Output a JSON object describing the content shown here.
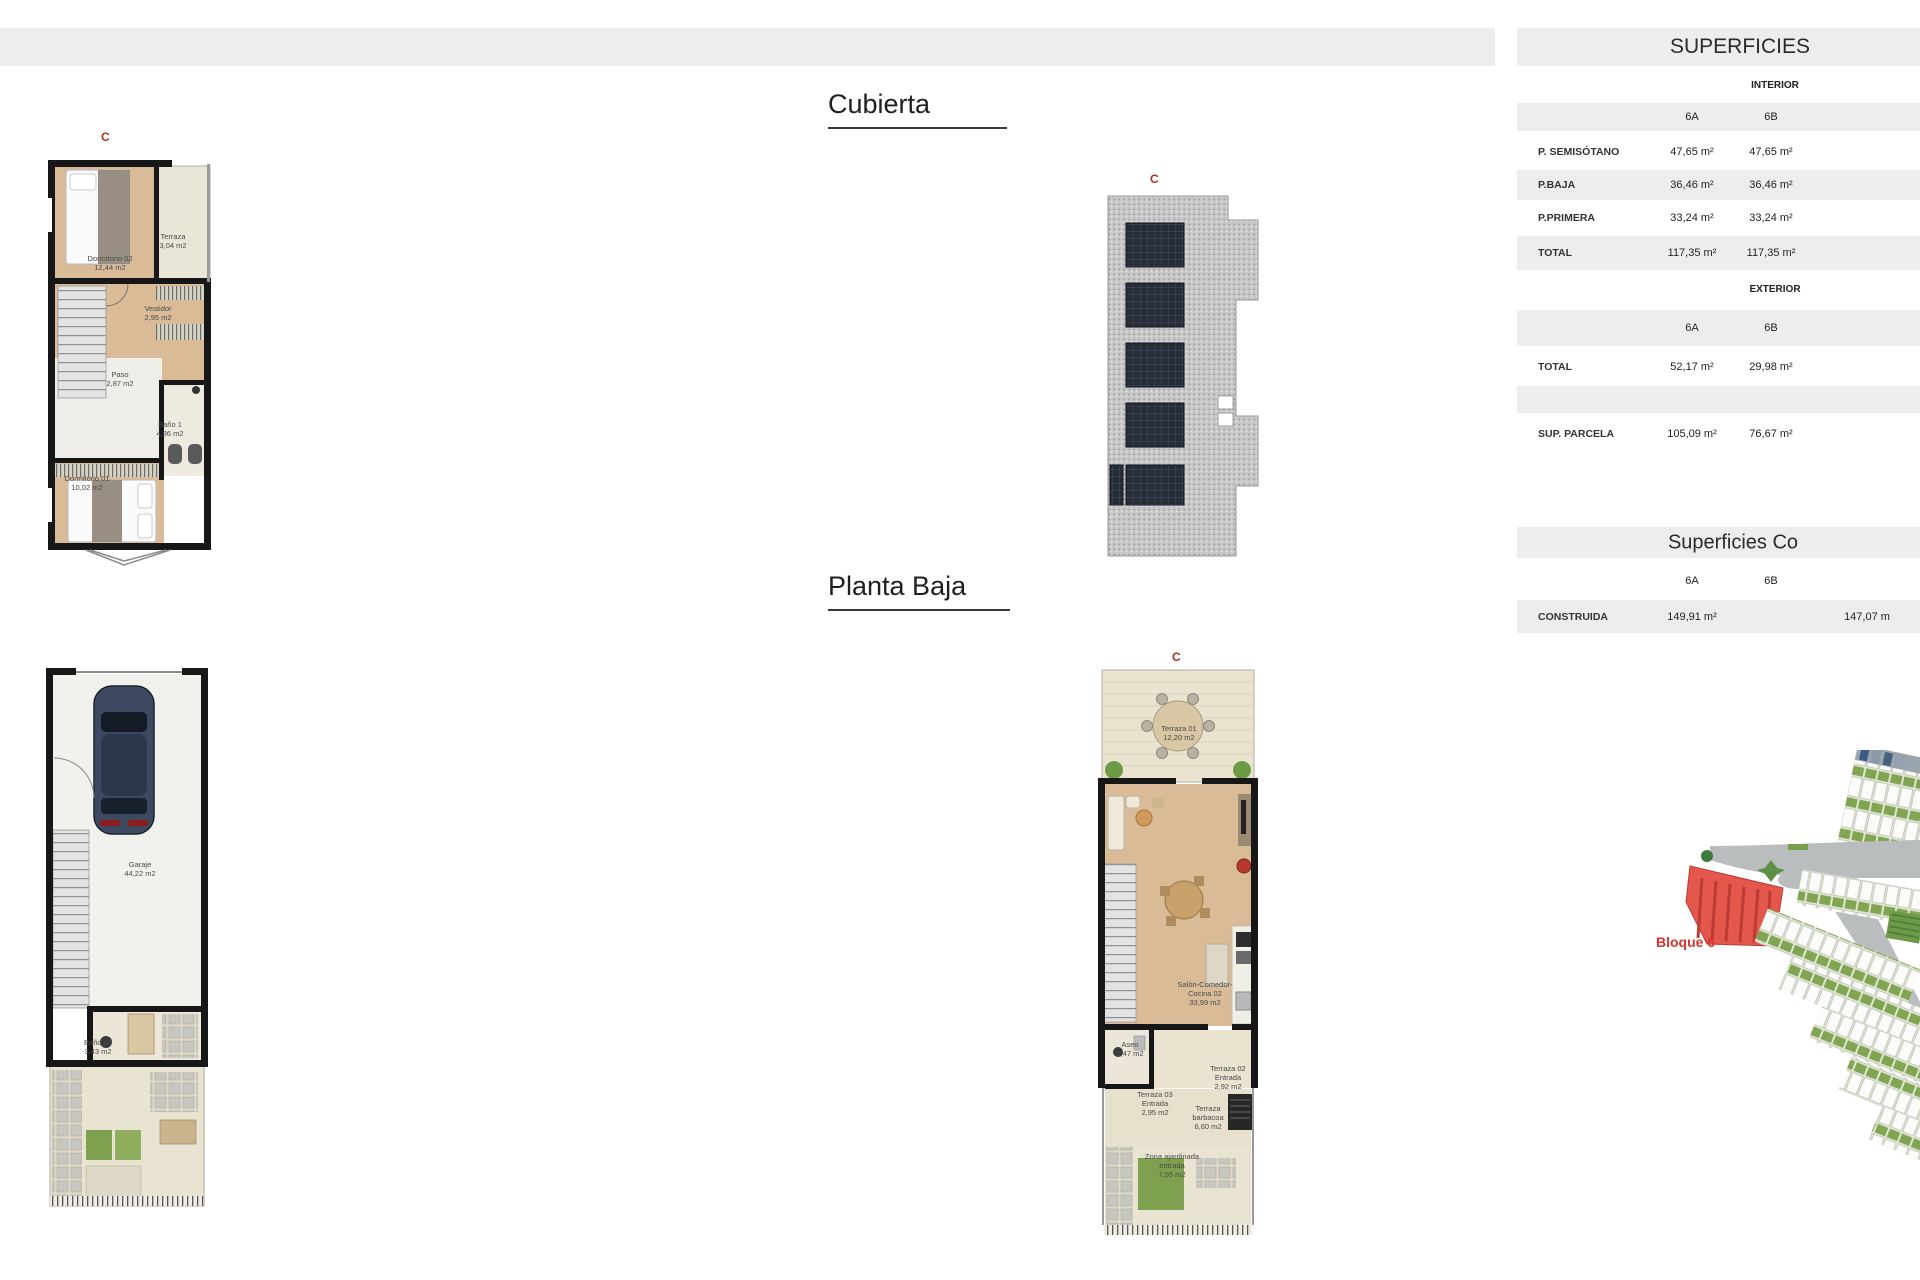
{
  "titles": {
    "cubierta": "Cubierta",
    "planta_baja": "Planta Baja"
  },
  "markers": {
    "c1": "C",
    "c2": "C",
    "c3": "C"
  },
  "plans": {
    "planta_primera": {
      "rooms": {
        "dormitorio02": {
          "name": "Dormitorio 02",
          "area": "12,44 m2"
        },
        "terraza": {
          "name": "Terraza",
          "area": "3,04 m2"
        },
        "vestidor": {
          "name": "Vestidor",
          "area": "2,95 m2"
        },
        "paso": {
          "name": "Paso",
          "area": "2,87 m2"
        },
        "bano1": {
          "name": "Baño 1",
          "area": "4,86 m2"
        },
        "dormitorio01": {
          "name": "Dormitorio 01",
          "area": "10,02 m2"
        }
      }
    },
    "semisotano": {
      "rooms": {
        "garaje": {
          "name": "Garaje",
          "area": "44,22 m2"
        },
        "bano01": {
          "name": "Baño 01",
          "area": "3,43 m2"
        }
      }
    },
    "planta_baja": {
      "rooms": {
        "terraza01": {
          "name": "Terraza 01",
          "area": "12,20 m2"
        },
        "salon": {
          "name": "Salón-Comedor-Cocina 02",
          "area": "33,99 m2"
        },
        "aseo": {
          "name": "Aseo",
          "area": "2,47 m2"
        },
        "terraza02": {
          "name": "Terraza 02 Entrada",
          "area": "2,92 m2"
        },
        "terraza03": {
          "name": "Terraza 03 Entrada",
          "area": "2,95 m2"
        },
        "barbacoa": {
          "name": "Terraza barbacoa",
          "area": "6,60 m2"
        },
        "zona": {
          "name": "Zona ajardinada entrada",
          "area": "7,55 m2"
        }
      }
    }
  },
  "superficies": {
    "title": "SUPERFICIES",
    "interior": {
      "header": "INTERIOR",
      "col_a": "6A",
      "col_b": "6B",
      "rows": [
        {
          "label": "P. SEMISÓTANO",
          "a": "47,65 m²",
          "b": "47,65 m²"
        },
        {
          "label": "P.BAJA",
          "a": "36,46 m²",
          "b": "36,46 m²"
        },
        {
          "label": "P.PRIMERA",
          "a": "33,24 m²",
          "b": "33,24 m²"
        },
        {
          "label": "TOTAL",
          "a": "117,35 m²",
          "b": "117,35 m²"
        }
      ]
    },
    "exterior": {
      "header": "EXTERIOR",
      "col_a": "6A",
      "col_b": "6B",
      "rows": [
        {
          "label": "TOTAL",
          "a": "52,17 m²",
          "b": "29,98 m²"
        },
        {
          "label": "SUP. PARCELA",
          "a": "105,09 m²",
          "b": "76,67 m²"
        }
      ]
    }
  },
  "construidas": {
    "title": "Superficies Co",
    "col_a": "6A",
    "col_b": "6B",
    "rows": [
      {
        "label": "CONSTRUIDA",
        "a": "149,91 m²",
        "b": "147,07 m"
      }
    ]
  },
  "site_plan": {
    "label": "Bloque 6"
  },
  "colors": {
    "accent_red": "#b03025",
    "bloque_red": "#d7352e",
    "row_shade": "#eceeee",
    "wood": "#d9bb97",
    "wall": "#171717",
    "road": "#b9bdbd",
    "green": "#7da14f"
  }
}
